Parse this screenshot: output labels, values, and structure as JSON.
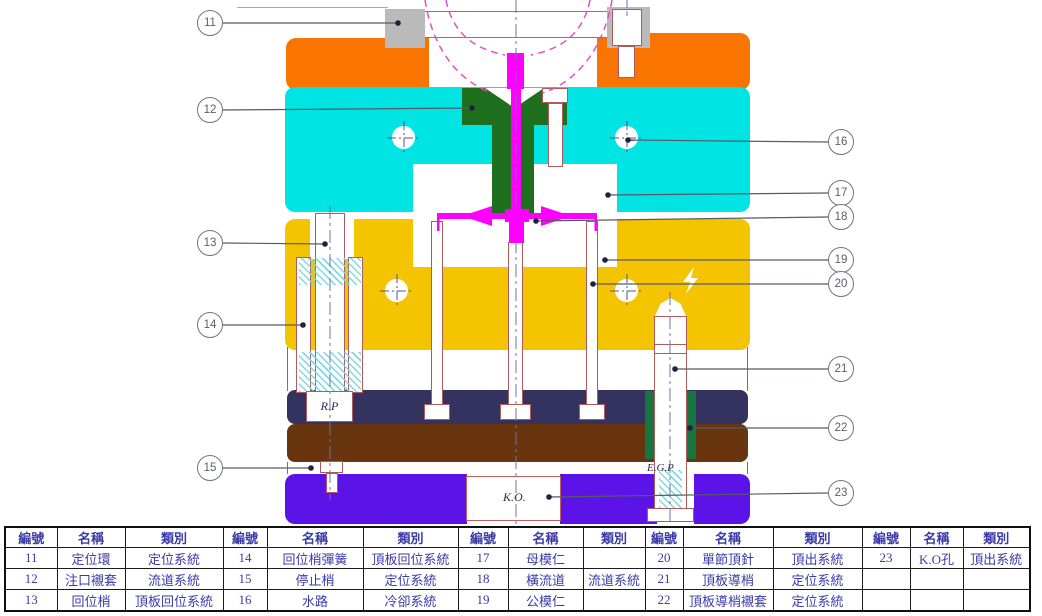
{
  "diagram": {
    "labels": {
      "return_pin": "R.P",
      "ejector_guide_pin": "E.G.P",
      "knockout": "K.O."
    },
    "callouts": [
      {
        "no": "11",
        "bx": 210,
        "by": 23,
        "tx": 398,
        "ty": 23
      },
      {
        "no": "12",
        "bx": 210,
        "by": 110,
        "tx": 472,
        "ty": 108
      },
      {
        "no": "13",
        "bx": 210,
        "by": 243,
        "tx": 325,
        "ty": 244
      },
      {
        "no": "14",
        "bx": 210,
        "by": 325,
        "tx": 303,
        "ty": 325
      },
      {
        "no": "15",
        "bx": 210,
        "by": 468,
        "tx": 311,
        "ty": 468
      },
      {
        "no": "16",
        "bx": 841,
        "by": 142,
        "tx": 628,
        "ty": 140
      },
      {
        "no": "17",
        "bx": 841,
        "by": 193,
        "tx": 608,
        "ty": 195
      },
      {
        "no": "18",
        "bx": 841,
        "by": 217,
        "tx": 536,
        "ty": 221
      },
      {
        "no": "19",
        "bx": 841,
        "by": 260,
        "tx": 605,
        "ty": 260
      },
      {
        "no": "20",
        "bx": 841,
        "by": 284,
        "tx": 593,
        "ty": 284
      },
      {
        "no": "21",
        "bx": 841,
        "by": 369,
        "tx": 675,
        "ty": 369
      },
      {
        "no": "22",
        "bx": 841,
        "by": 428,
        "tx": 690,
        "ty": 428
      },
      {
        "no": "23",
        "bx": 841,
        "by": 493,
        "tx": 549,
        "ty": 497
      }
    ],
    "colors": {
      "top_clamp_plate": "#f97400",
      "cavity_plate": "#00e4e4",
      "sprue_bushing": "#1e6f1e",
      "core_plate": "#f4c400",
      "ejector_retainer_plate": "#34325f",
      "ejector_base_plate": "#68350f",
      "bottom_clamp_plate": "#5b13e8",
      "locating_ring": "#bababa",
      "melt": "#ff00ff",
      "guide_bushing_green": "#17753f"
    }
  },
  "table": {
    "headers": [
      "編號",
      "名稱",
      "類別",
      "編號",
      "名稱",
      "類別",
      "編號",
      "名稱",
      "類別",
      "編號",
      "名稱",
      "類別",
      "編號",
      "名稱",
      "類別"
    ],
    "rows": [
      [
        "11",
        "定位環",
        "定位系統",
        "14",
        "回位梢彈簧",
        "頂板回位系統",
        "17",
        "母模仁",
        "",
        "20",
        "單節頂針",
        "頂出系統",
        "23",
        "K.O孔",
        "頂出系統"
      ],
      [
        "12",
        "注口襯套",
        "流道系統",
        "15",
        "停止梢",
        "定位系統",
        "18",
        "橫流道",
        "流道系統",
        "21",
        "頂板導梢",
        "定位系統",
        "",
        "",
        ""
      ],
      [
        "13",
        "回位梢",
        "頂板回位系統",
        "16",
        "水路",
        "冷卻系統",
        "19",
        "公模仁",
        "",
        "22",
        "頂板導梢襯套",
        "定位系統",
        "",
        "",
        ""
      ]
    ]
  }
}
